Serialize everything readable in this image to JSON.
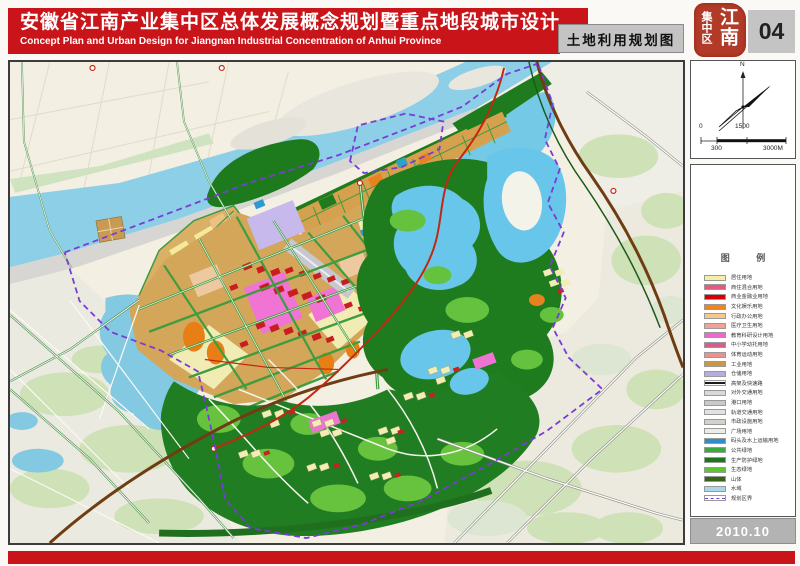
{
  "header": {
    "title_cn": "安徽省江南产业集中区总体发展概念规划暨重点地段城市设计",
    "title_en": "Concept Plan and Urban Design for Jiangnan Industrial Concentration of Anhui Province",
    "map_title": "土地利用规划图",
    "sheet_number": "04"
  },
  "seal": {
    "line_right": "江南",
    "line_left": "集中区"
  },
  "north_arrow": {
    "label": "N"
  },
  "scale_bar": {
    "top_left": "0",
    "top_mid": "1500",
    "bottom_left": "300",
    "bottom_right": "3000M"
  },
  "legend": {
    "title": "图 例",
    "items": [
      {
        "label": "居住用地",
        "color": "#f6f0a6",
        "type": "fill"
      },
      {
        "label": "商住混合用地",
        "color": "#e45b80",
        "type": "fill"
      },
      {
        "label": "商业金融业用地",
        "color": "#d60000",
        "type": "fill"
      },
      {
        "label": "文化娱乐用地",
        "color": "#f08222",
        "type": "fill"
      },
      {
        "label": "行政办公用地",
        "color": "#f6c78e",
        "type": "fill"
      },
      {
        "label": "医疗卫生用地",
        "color": "#f2a396",
        "type": "fill"
      },
      {
        "label": "教育科研设计用地",
        "color": "#ef68cd",
        "type": "fill"
      },
      {
        "label": "中小学幼托用地",
        "color": "#d2608a",
        "type": "fill"
      },
      {
        "label": "体育运动用地",
        "color": "#ec8f8f",
        "type": "fill"
      },
      {
        "label": "工业用地",
        "color": "#c99a3f",
        "type": "fill"
      },
      {
        "label": "仓储用地",
        "color": "#b7abe2",
        "type": "fill"
      },
      {
        "label": "高架及快速路",
        "color": "#1a1a1a",
        "type": "line"
      },
      {
        "label": "对外交通用地",
        "color": "#d9d9d9",
        "type": "fill"
      },
      {
        "label": "港口用地",
        "color": "#c9c9c9",
        "type": "fill"
      },
      {
        "label": "轨道交通用地",
        "color": "#e2e2e2",
        "type": "fill"
      },
      {
        "label": "市政设施用地",
        "color": "#d2d2cb",
        "type": "fill"
      },
      {
        "label": "广场用地",
        "color": "#e9efe7",
        "type": "fill"
      },
      {
        "label": "码头及水上运输用地",
        "color": "#2e8ec6",
        "type": "fill"
      },
      {
        "label": "公共绿地",
        "color": "#3cab3c",
        "type": "fill"
      },
      {
        "label": "生产防护绿地",
        "color": "#177917",
        "type": "fill"
      },
      {
        "label": "生态绿地",
        "color": "#5cc531",
        "type": "fill"
      },
      {
        "label": "山体",
        "color": "#36621c",
        "type": "fill"
      },
      {
        "label": "水域",
        "color": "#a9d7ee",
        "type": "fill"
      },
      {
        "label": "规划区界",
        "color": "#7a3fd4",
        "type": "dash"
      }
    ]
  },
  "footer": {
    "date": "2010.10"
  },
  "palette": {
    "banner_red": "#c9151a",
    "panel_gray": "#c4c4c4",
    "river_blue": "#8ccfe7",
    "lake_blue": "#67c6e9",
    "forest_green": "#1e7c1e",
    "road_green": "#3f9c3f",
    "city_tan": "#d3a65a",
    "boundary_purple": "#7a3bd6",
    "highway_brown": "#6f3d12",
    "main_road_red": "#c22810"
  }
}
